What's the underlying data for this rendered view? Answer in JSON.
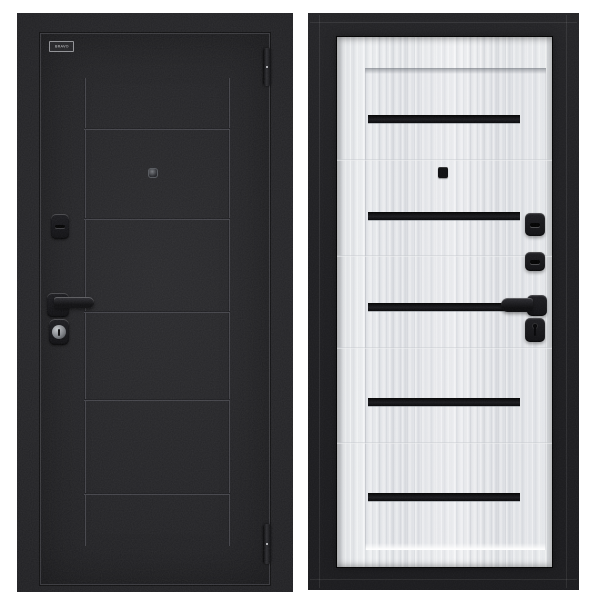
{
  "page": {
    "background_color": "#ffffff",
    "description_of_visible_content": "two door product photos side by side"
  },
  "exterior_door": {
    "logo_text": "BRAVO",
    "finish_color": "#212124",
    "groove_highlight_color": "#55555c",
    "hardware_color": "#121215",
    "horizontal_groove_count": 5,
    "vertical_groove_count": 2,
    "hinge_count": 2
  },
  "interior_door": {
    "frame_color": "#1d1d20",
    "leaf_color": "#e8e9eb",
    "glass_insert_color": "#0a0a0c",
    "glass_insert_count": 5,
    "hardware_color": "#141418"
  }
}
